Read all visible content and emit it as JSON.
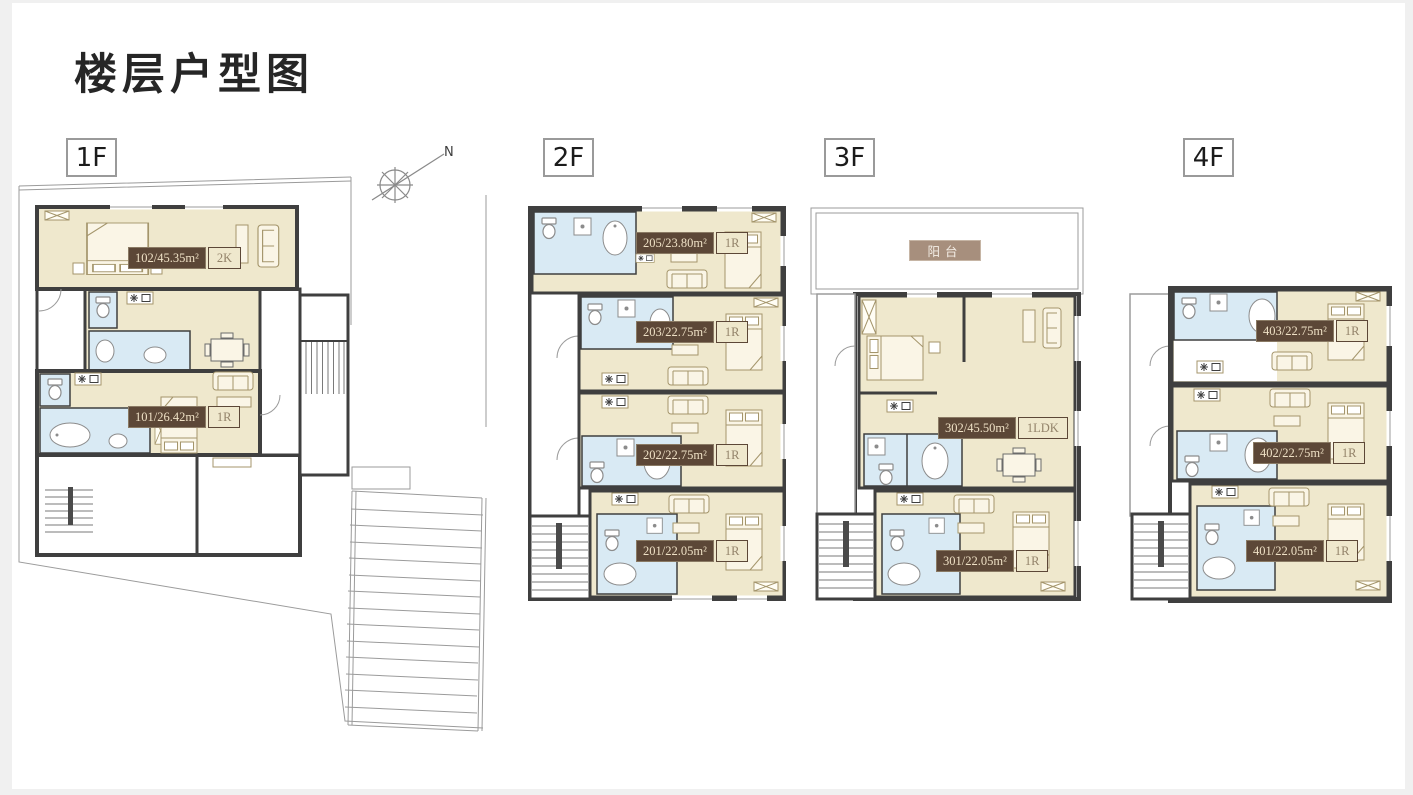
{
  "title": "楼层户型图",
  "compass": {
    "north": "N"
  },
  "floors": {
    "f1": {
      "badge": "1F",
      "units": {
        "u102": {
          "label": "102/45.35m²",
          "type": "2K"
        },
        "u101": {
          "label": "101/26.42m²",
          "type": "1R"
        }
      }
    },
    "f2": {
      "badge": "2F",
      "units": {
        "u205": {
          "label": "205/23.80m²",
          "type": "1R"
        },
        "u203": {
          "label": "203/22.75m²",
          "type": "1R"
        },
        "u202": {
          "label": "202/22.75m²",
          "type": "1R"
        },
        "u201": {
          "label": "201/22.05m²",
          "type": "1R"
        }
      }
    },
    "f3": {
      "badge": "3F",
      "balcony": "阳台",
      "units": {
        "u302": {
          "label": "302/45.50m²",
          "type": "1LDK"
        },
        "u301": {
          "label": "301/22.05m²",
          "type": "1R"
        }
      }
    },
    "f4": {
      "badge": "4F",
      "units": {
        "u403": {
          "label": "403/22.75m²",
          "type": "1R"
        },
        "u402": {
          "label": "402/22.75m²",
          "type": "1R"
        },
        "u401": {
          "label": "401/22.05m²",
          "type": "1R"
        }
      }
    }
  },
  "colors": {
    "room": "#efe8cd",
    "bathroom": "#d9eaf4",
    "wall": "#3f3f3f",
    "label_bg": "#5c4737",
    "label_text": "#eee0c5",
    "type_text": "#93836a",
    "balcony_bg": "#a78f7d"
  }
}
